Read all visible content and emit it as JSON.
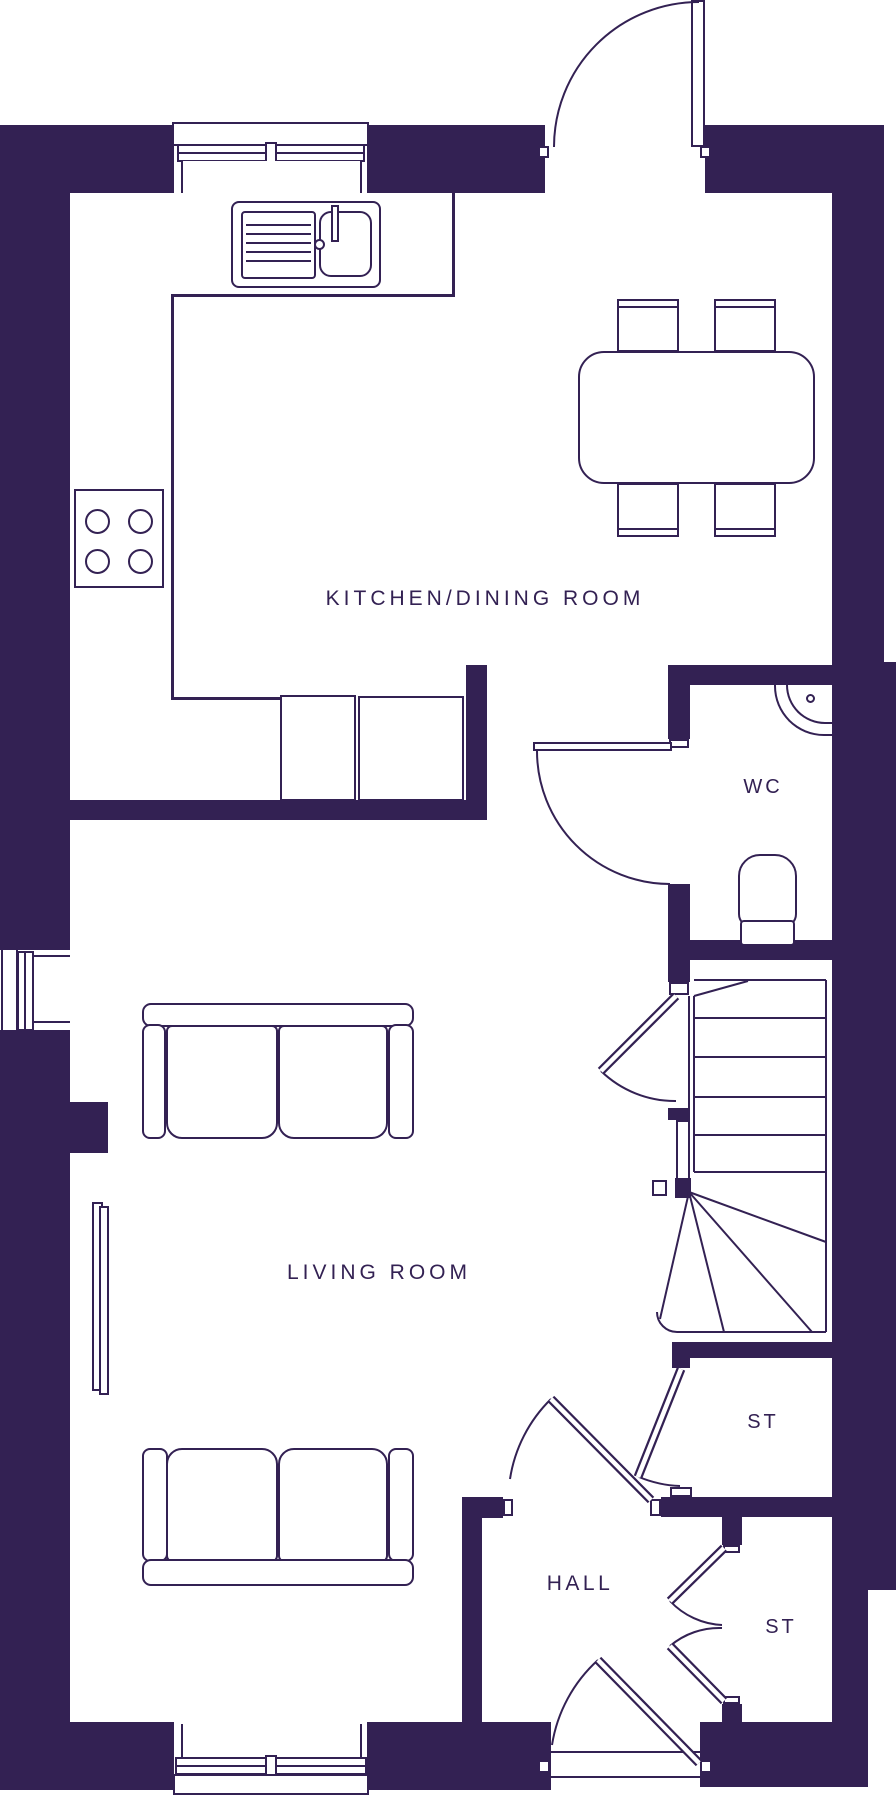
{
  "colors": {
    "ink": "#332153",
    "background": "#ffffff"
  },
  "rooms": {
    "kitchen_dining": "KITCHEN/DINING ROOM",
    "wc": "WC",
    "living": "LIVING ROOM",
    "storage_1": "ST",
    "hall": "HALL",
    "storage_2": "ST"
  }
}
